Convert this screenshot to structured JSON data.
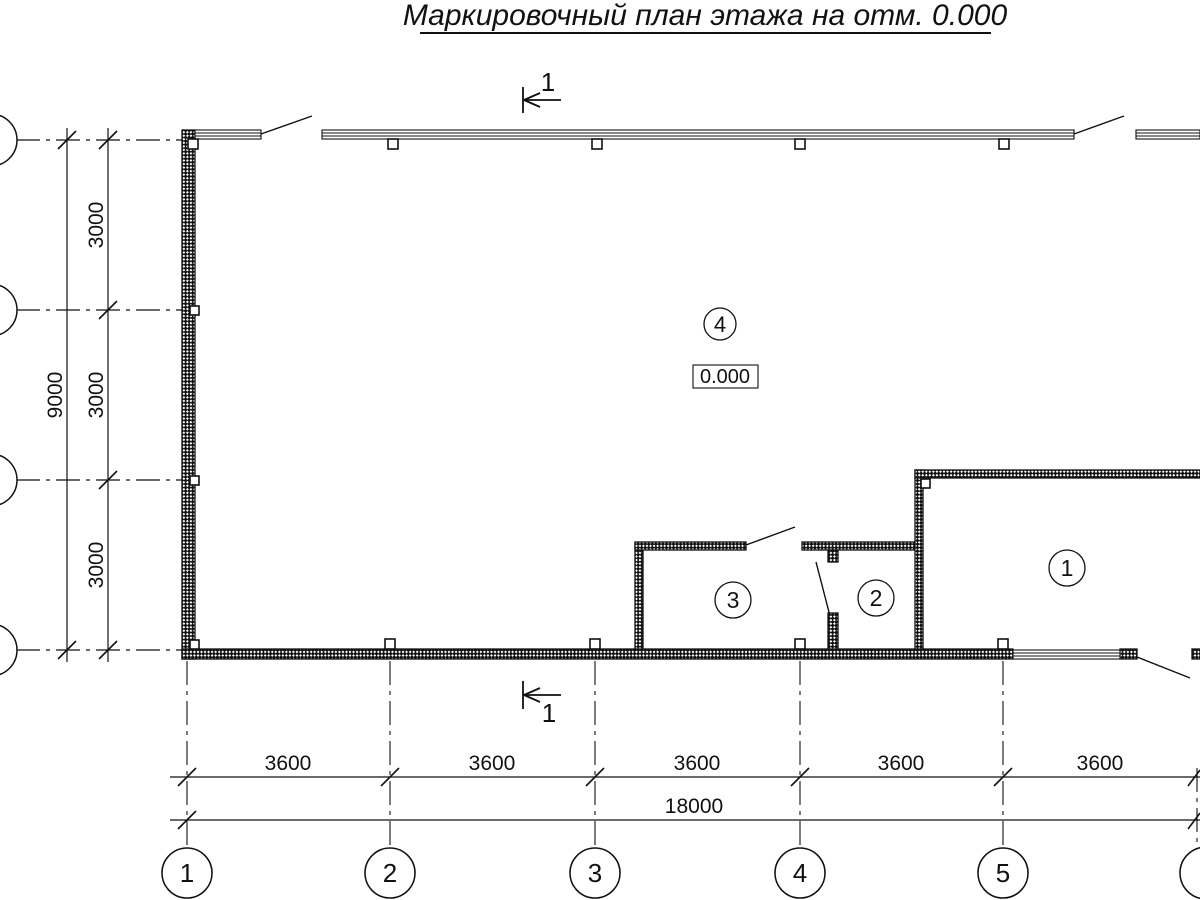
{
  "title": "Маркировочный план этажа на отм. 0.000",
  "drawing": {
    "elevation_mark": "0.000",
    "section": {
      "top_label": "1",
      "bottom_label": "1"
    },
    "rooms": [
      {
        "number": "4"
      },
      {
        "number": "3"
      },
      {
        "number": "2"
      },
      {
        "number": "1"
      }
    ]
  },
  "axes": {
    "bottom": [
      "1",
      "2",
      "3",
      "4",
      "5",
      "6"
    ]
  },
  "dimensions": {
    "vertical_segments": [
      "3000",
      "3000",
      "3000"
    ],
    "vertical_total": "9000",
    "horizontal_segments": [
      "3600",
      "3600",
      "3600",
      "3600",
      "3600"
    ],
    "horizontal_total": "18000"
  },
  "colors": {
    "line": "#111111",
    "background": "#ffffff"
  }
}
